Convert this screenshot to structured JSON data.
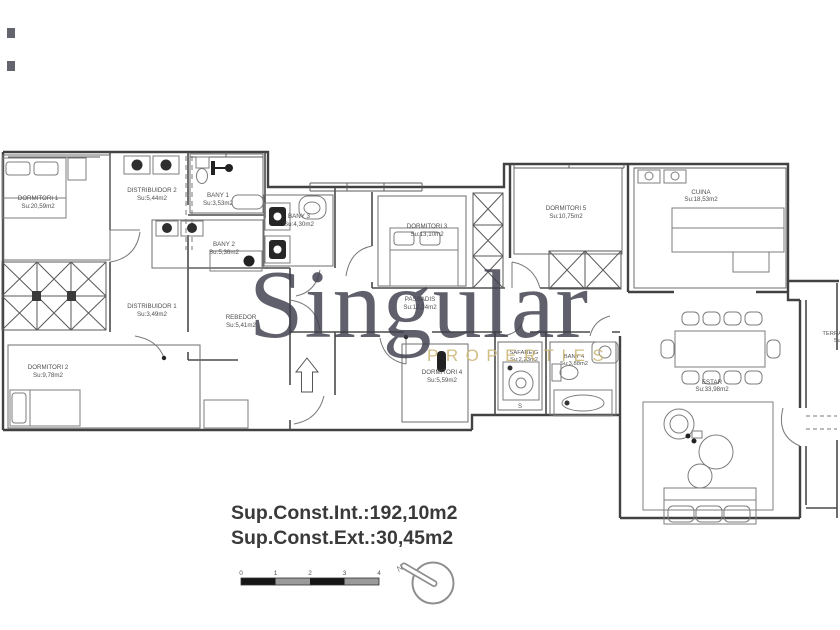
{
  "watermark": {
    "brand": "Singular",
    "subtitle": "PROPERTIES",
    "brand_color": "#3e3e4c",
    "subtitle_color": "#cdb878"
  },
  "summary": {
    "interior": "Sup.Const.Int.:192,10m2",
    "exterior": "Sup.Const.Ext.:30,45m2"
  },
  "rooms": [
    {
      "id": "dormitori-1",
      "name": "DORMITORI 1",
      "area": "Su:20,59m2"
    },
    {
      "id": "distribuidor-2",
      "name": "DISTRIBUIDOR 2",
      "area": "Su:5,44m2"
    },
    {
      "id": "bany-1",
      "name": "BANY 1",
      "area": "Su:3,53m2"
    },
    {
      "id": "bany-2",
      "name": "BANY 2",
      "area": "Su:5,36m2"
    },
    {
      "id": "bany-3",
      "name": "BANY 3",
      "area": "Su:4,30m2"
    },
    {
      "id": "distribuidor-1",
      "name": "DISTRIBUIDOR 1",
      "area": "Su:3,49m2"
    },
    {
      "id": "rebedor",
      "name": "REBEDOR",
      "area": "Su:5,41m2"
    },
    {
      "id": "dormitori-2",
      "name": "DORMITORI 2",
      "area": "Su:9,78m2"
    },
    {
      "id": "dormitori-3",
      "name": "DORMITORI 3",
      "area": "Su:13,10m2"
    },
    {
      "id": "passadis",
      "name": "PASSADIS",
      "area": "Su:12,24m2"
    },
    {
      "id": "dormitori-4",
      "name": "DORMITORI 4",
      "area": "Su:5,59m2"
    },
    {
      "id": "safareig",
      "name": "SAFAREIG",
      "area": "Su:2,23m2"
    },
    {
      "id": "bany-4",
      "name": "BANY 4",
      "area": "Su:3,88m2"
    },
    {
      "id": "dormitori-5",
      "name": "DORMITORI 5",
      "area": "Su:10,75m2"
    },
    {
      "id": "cuina",
      "name": "CUINA",
      "area": "Su:18,53m2"
    },
    {
      "id": "estar",
      "name": "ESTAR",
      "area": "Su:33,98m2"
    },
    {
      "id": "terrassa",
      "name": "TERRASSA",
      "area": "Su:"
    }
  ],
  "scale_bar": {
    "ticks": [
      "0",
      "1",
      "2",
      "3",
      "4"
    ]
  },
  "compass": {
    "north_label": "N"
  },
  "annotations": {
    "step_label": "S"
  },
  "colors": {
    "walls": "#424242",
    "labels": "#4f4f4f",
    "summary_text": "#3a3a3a"
  }
}
